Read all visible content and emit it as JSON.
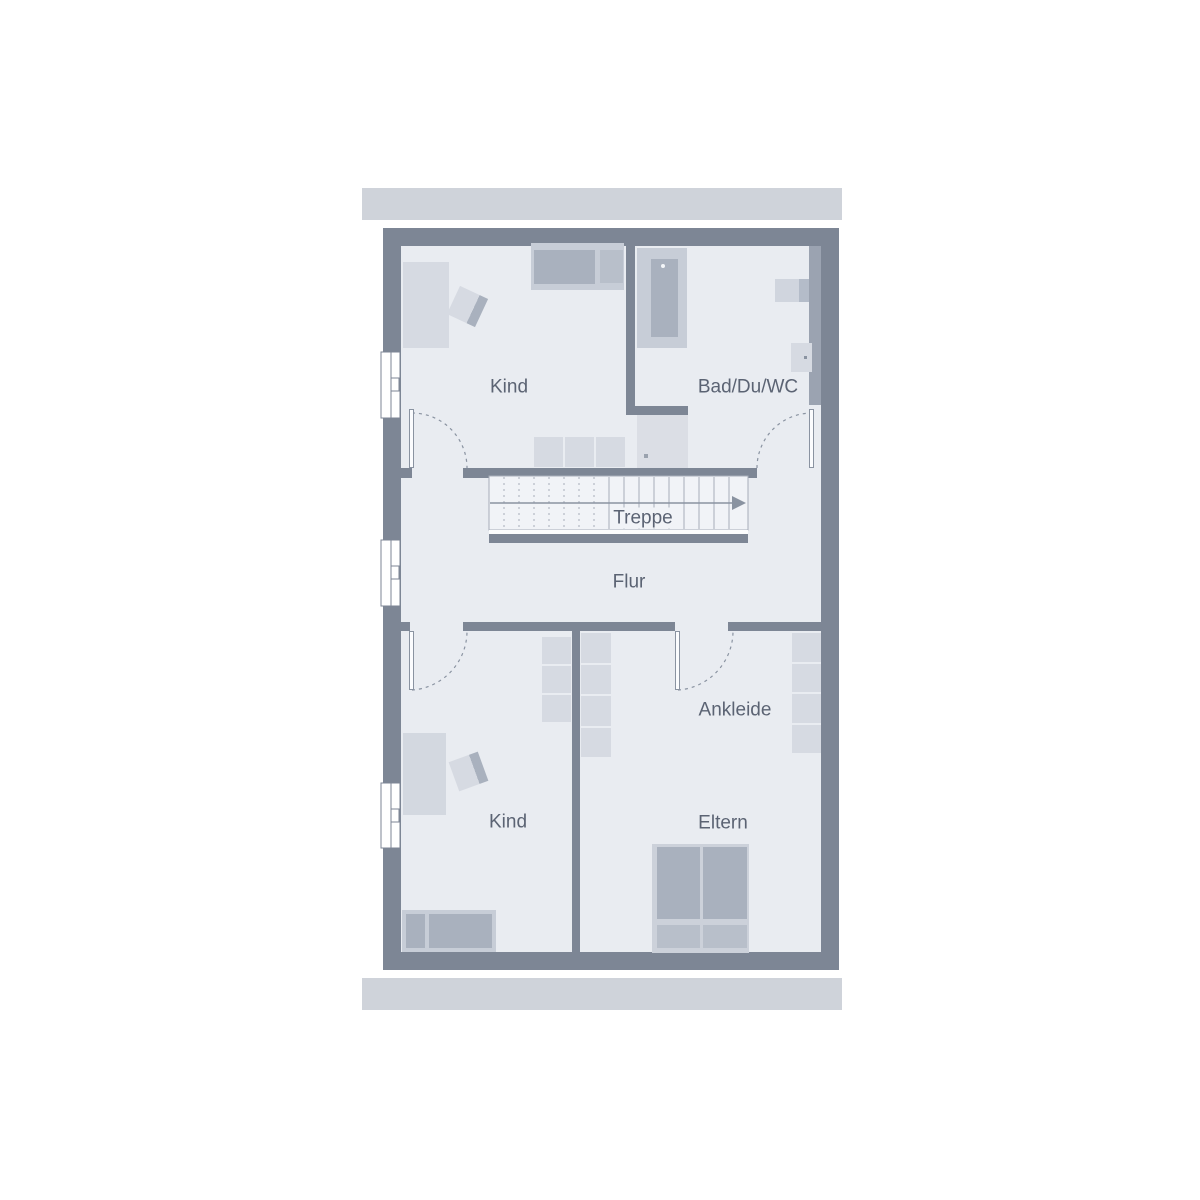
{
  "floorplan": {
    "labels": {
      "kind_top": "Kind",
      "bad": "Bad/Du/WC",
      "treppe": "Treppe",
      "flur": "Flur",
      "ankleide": "Ankleide",
      "kind_bottom": "Kind",
      "eltern": "Eltern"
    },
    "colors": {
      "wall": "#7d8695",
      "floor": "#e9ecf1",
      "roof_band": "#cfd3da",
      "furniture_light": "#d6dae2",
      "furniture_mid": "#c7cdd7",
      "furniture_dark": "#a9b1be",
      "pillow": "#b8bfca",
      "install": "#9ba3b1",
      "stair_fill": "#f1f3f7",
      "line": "#8a93a1",
      "label_text": "#5b6373"
    }
  }
}
